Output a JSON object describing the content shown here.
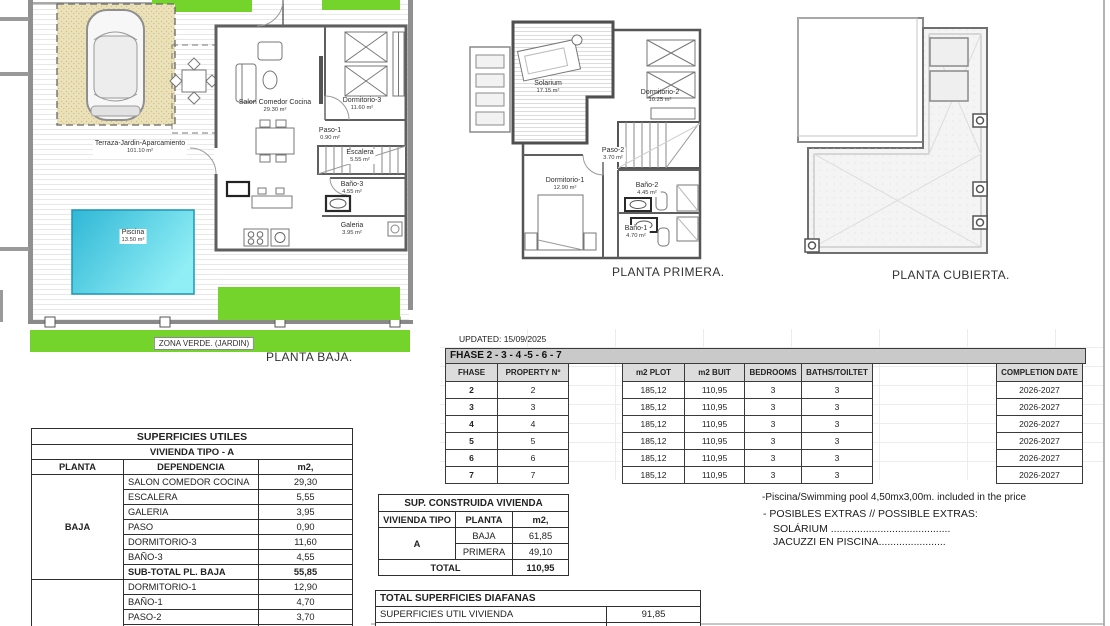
{
  "colors": {
    "green": "#74d42c",
    "pool_dark": "#2fb7d6",
    "pool_light": "#90eef5",
    "garage_sand": "#ebe2ba",
    "band_gray": "#c9c9c9",
    "header_gray": "#dcdcdc"
  },
  "plans": {
    "baja": {
      "caption": "PLANTA BAJA.",
      "zona_verde": "ZONA VERDE. (JARDIN)",
      "rooms": [
        {
          "name": "Terraza-Jardin-Aparcamiento",
          "area": "101.10 m²"
        },
        {
          "name": "Salon Comedor Cocina",
          "area": "29.30 m²"
        },
        {
          "name": "Dormitorio-3",
          "area": "11.60 m²"
        },
        {
          "name": "Paso-1",
          "area": "0.90 m²"
        },
        {
          "name": "Escalera",
          "area": "5.55 m²"
        },
        {
          "name": "Baño-3",
          "area": "4.55 m²"
        },
        {
          "name": "Galeria",
          "area": "3.95 m²"
        },
        {
          "name": "Piscina",
          "area": "13.50 m²"
        }
      ]
    },
    "primera": {
      "caption": "PLANTA PRIMERA.",
      "rooms": [
        {
          "name": "Solarium",
          "area": "17.15 m²"
        },
        {
          "name": "Dormitorio-2",
          "area": "10.25 m²"
        },
        {
          "name": "Paso-2",
          "area": "3.70 m²"
        },
        {
          "name": "Dormitorio-1",
          "area": "12.90 m²"
        },
        {
          "name": "Baño-2",
          "area": "4.45 m²"
        },
        {
          "name": "Baño-1",
          "area": "4.70 m²"
        }
      ]
    },
    "cubierta": {
      "caption": "PLANTA CUBIERTA."
    }
  },
  "fhase_table": {
    "updated": "UPDATED: 15/09/2025",
    "band": "FHASE  2 - 3 - 4 -5 - 6 - 7",
    "headers": {
      "fhase": "FHASE",
      "property": "PROPERTY Nº",
      "plot": "m2 PLOT",
      "built": "m2 BUIT",
      "bedrooms": "BEDROOMS",
      "baths": "BATHS/TOILTET",
      "completion": "COMPLETION DATE"
    },
    "rows": [
      {
        "fhase": "2",
        "property": "2",
        "plot": "185,12",
        "built": "110,95",
        "bedrooms": "3",
        "baths": "3",
        "completion": "2026-2027"
      },
      {
        "fhase": "3",
        "property": "3",
        "plot": "185,12",
        "built": "110,95",
        "bedrooms": "3",
        "baths": "3",
        "completion": "2026-2027"
      },
      {
        "fhase": "4",
        "property": "4",
        "plot": "185,12",
        "built": "110,95",
        "bedrooms": "3",
        "baths": "3",
        "completion": "2026-2027"
      },
      {
        "fhase": "5",
        "property": "5",
        "plot": "185,12",
        "built": "110,95",
        "bedrooms": "3",
        "baths": "3",
        "completion": "2026-2027"
      },
      {
        "fhase": "6",
        "property": "6",
        "plot": "185,12",
        "built": "110,95",
        "bedrooms": "3",
        "baths": "3",
        "completion": "2026-2027"
      },
      {
        "fhase": "7",
        "property": "7",
        "plot": "185,12",
        "built": "110,95",
        "bedrooms": "3",
        "baths": "3",
        "completion": "2026-2027"
      }
    ]
  },
  "superficies_utiles": {
    "title": "SUPERFICIES UTILES",
    "subtitle": "VIVIENDA TIPO - A",
    "headers": {
      "planta": "PLANTA",
      "dependencia": "DEPENDENCIA",
      "m2": "m2,"
    },
    "baja_label": "BAJA",
    "baja_rows": [
      {
        "dep": "SALON COMEDOR COCINA",
        "m2": "29,30"
      },
      {
        "dep": "ESCALERA",
        "m2": "5,55"
      },
      {
        "dep": "GALERIA",
        "m2": "3,95"
      },
      {
        "dep": "PASO",
        "m2": "0,90"
      },
      {
        "dep": "DORMITORIO-3",
        "m2": "11,60"
      },
      {
        "dep": "BAÑO-3",
        "m2": "4,55"
      }
    ],
    "subtotal": {
      "dep": "SUB-TOTAL PL. BAJA",
      "m2": "55,85"
    },
    "primera_label": "PRIMERA",
    "primera_rows": [
      {
        "dep": "DORMITORIO-1",
        "m2": "12,90"
      },
      {
        "dep": "BAÑO-1",
        "m2": "4,70"
      },
      {
        "dep": "PASO-2",
        "m2": "3,70"
      },
      {
        "dep": "BAÑO-2",
        "m2": "4,45"
      }
    ]
  },
  "sup_construida": {
    "title": "SUP. CONSTRUIDA VIVIENDA",
    "headers": {
      "tipo": "VIVIENDA TIPO",
      "planta": "PLANTA",
      "m2": "m2,"
    },
    "tipo": "A",
    "rows": [
      {
        "planta": "BAJA",
        "m2": "61,85"
      },
      {
        "planta": "PRIMERA",
        "m2": "49,10"
      }
    ],
    "total_label": "TOTAL",
    "total": "110,95"
  },
  "diafanas": {
    "title": "TOTAL SUPERFICIES DIAFANAS",
    "rows": [
      {
        "label": "SUPERFICIES UTIL VIVIENDA",
        "m2": "91,85"
      },
      {
        "label": "SOLARIUM PL. PRIMERA",
        "m2": "17,15"
      }
    ]
  },
  "notes": {
    "line1": "-Piscina/Swimming pool 4,50mx3,00m. included in the price",
    "line2": "- POSIBLES EXTRAS // POSSIBLE EXTRAS:",
    "line3": "SOLÁRIUM .........................................",
    "line4": "JACUZZI EN PISCINA......................."
  }
}
